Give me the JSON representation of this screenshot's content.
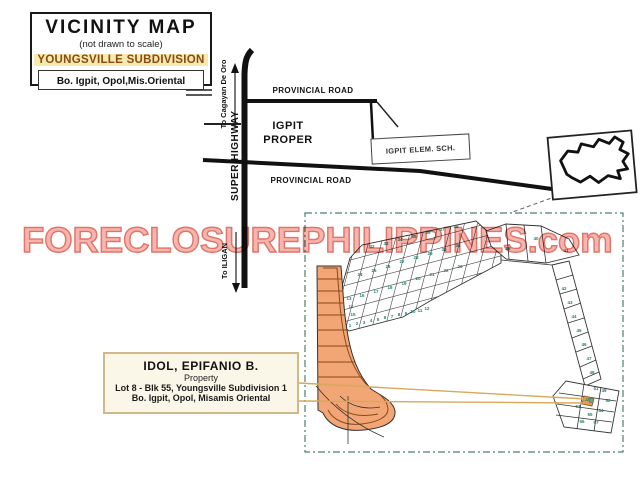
{
  "title_box": {
    "title": "VICINITY MAP",
    "subtitle": "(not drawn to scale)",
    "subdivision_name": "YOUNGSVILLE SUBDIVISION",
    "location_line": "Bo. Igpit, Opol,Mis.Oriental"
  },
  "map": {
    "road_top_label": "PROVINCIAL ROAD",
    "road_bottom_label": "PROVINCIAL ROAD",
    "highway_label": "SUPER HIGHWAY",
    "dir_north_label": "To Cagayan De Oro",
    "dir_south_label": "To ILIGAN",
    "district_label": "IGPIT PROPER",
    "school_label": "IGPIT ELEM. SCH."
  },
  "property_box": {
    "owner": "IDOL, EPIFANIO B.",
    "kind": "Property",
    "lot_line": "Lot 8 - Blk 55,  Youngsville  Subdivision 1",
    "address_line": "Bo. Igpit, Opol, Misamis Oriental"
  },
  "watermark": {
    "text": "FORECLOSUREPHILIPPINES.com",
    "fill": "#f6b5ad",
    "outline": "#e2746a"
  },
  "colors": {
    "highlight_strip": "#f2a575",
    "lot_number": "#1b7f72",
    "leader_line": "#d9a85c",
    "dashed_border": "#4e7f73",
    "subdivision_text": "#8a4a10",
    "subdivision_bg": "#f7eab0"
  },
  "plat": {
    "lot_numbers": [
      {
        "n": "1",
        "x": 350,
        "y": 327
      },
      {
        "n": "2",
        "x": 357,
        "y": 325
      },
      {
        "n": "3",
        "x": 364,
        "y": 324
      },
      {
        "n": "4",
        "x": 371,
        "y": 322
      },
      {
        "n": "5",
        "x": 378,
        "y": 321
      },
      {
        "n": "6",
        "x": 385,
        "y": 319
      },
      {
        "n": "7",
        "x": 392,
        "y": 318
      },
      {
        "n": "8",
        "x": 399,
        "y": 316
      },
      {
        "n": "9",
        "x": 406,
        "y": 315
      },
      {
        "n": "10",
        "x": 413,
        "y": 313
      },
      {
        "n": "11",
        "x": 420,
        "y": 312
      },
      {
        "n": "12",
        "x": 427,
        "y": 310
      },
      {
        "n": "13",
        "x": 349,
        "y": 300
      },
      {
        "n": "14",
        "x": 351,
        "y": 308
      },
      {
        "n": "15",
        "x": 353,
        "y": 316
      },
      {
        "n": "16",
        "x": 362,
        "y": 297
      },
      {
        "n": "17",
        "x": 376,
        "y": 293
      },
      {
        "n": "18",
        "x": 390,
        "y": 289
      },
      {
        "n": "19",
        "x": 404,
        "y": 285
      },
      {
        "n": "20",
        "x": 418,
        "y": 280
      },
      {
        "n": "21",
        "x": 432,
        "y": 276
      },
      {
        "n": "22",
        "x": 446,
        "y": 272
      },
      {
        "n": "23",
        "x": 460,
        "y": 268
      },
      {
        "n": "24",
        "x": 360,
        "y": 276
      },
      {
        "n": "25",
        "x": 374,
        "y": 272
      },
      {
        "n": "26",
        "x": 388,
        "y": 268
      },
      {
        "n": "27",
        "x": 402,
        "y": 263
      },
      {
        "n": "28",
        "x": 416,
        "y": 259
      },
      {
        "n": "29",
        "x": 430,
        "y": 255
      },
      {
        "n": "30",
        "x": 444,
        "y": 251
      },
      {
        "n": "31",
        "x": 458,
        "y": 247
      },
      {
        "n": "32",
        "x": 372,
        "y": 248
      },
      {
        "n": "33",
        "x": 386,
        "y": 245
      },
      {
        "n": "34",
        "x": 400,
        "y": 241
      },
      {
        "n": "35",
        "x": 414,
        "y": 238
      },
      {
        "n": "36",
        "x": 428,
        "y": 234
      },
      {
        "n": "37",
        "x": 442,
        "y": 231
      },
      {
        "n": "38",
        "x": 456,
        "y": 228
      },
      {
        "n": "39",
        "x": 508,
        "y": 250
      },
      {
        "n": "40",
        "x": 536,
        "y": 240
      },
      {
        "n": "41",
        "x": 566,
        "y": 252
      },
      {
        "n": "42",
        "x": 564,
        "y": 290
      },
      {
        "n": "43",
        "x": 570,
        "y": 304
      },
      {
        "n": "44",
        "x": 574,
        "y": 318
      },
      {
        "n": "45",
        "x": 579,
        "y": 332
      },
      {
        "n": "46",
        "x": 584,
        "y": 346
      },
      {
        "n": "47",
        "x": 589,
        "y": 360
      },
      {
        "n": "48",
        "x": 592,
        "y": 374
      },
      {
        "n": "49",
        "x": 604,
        "y": 392
      },
      {
        "n": "50",
        "x": 608,
        "y": 402
      },
      {
        "n": "51",
        "x": 596,
        "y": 390
      },
      {
        "n": "52",
        "x": 587,
        "y": 401
      },
      {
        "n": "53",
        "x": 578,
        "y": 408
      },
      {
        "n": "54",
        "x": 601,
        "y": 412
      },
      {
        "n": "55",
        "x": 590,
        "y": 416
      },
      {
        "n": "56",
        "x": 582,
        "y": 423
      },
      {
        "n": "57",
        "x": 596,
        "y": 424
      }
    ]
  }
}
